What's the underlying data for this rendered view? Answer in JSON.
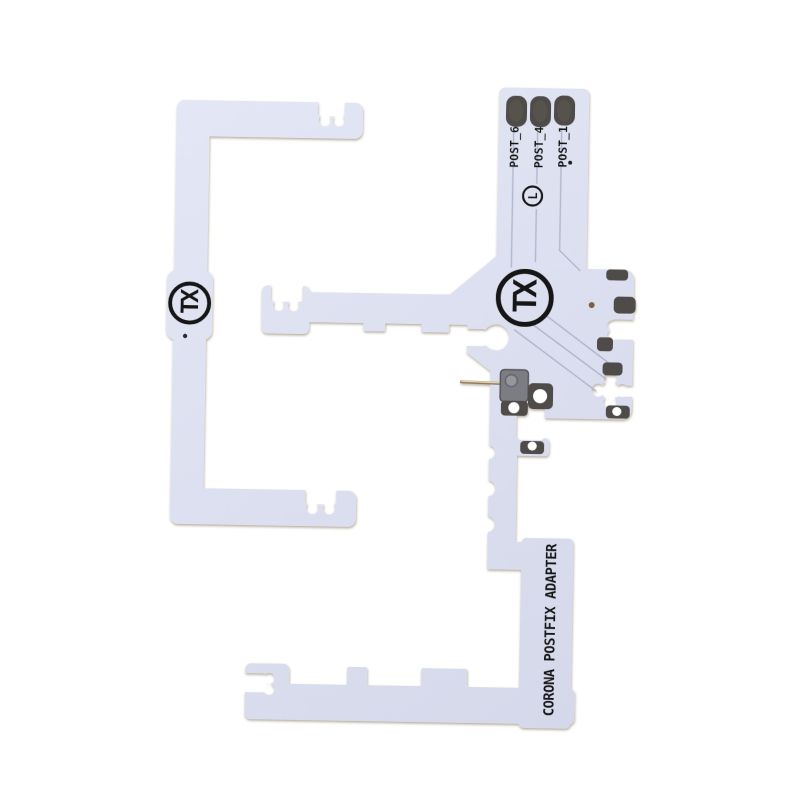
{
  "photo": {
    "background_color": "#ffffff",
    "board_color": "#dcdfef",
    "pad_color": "#4f4c48",
    "silkscreen_color": "#131313",
    "main_board": {
      "logo_text": "TX",
      "certification_mark": "L",
      "post_labels": [
        "POST_6",
        "POST_4",
        "POST_1"
      ],
      "title_text": "CORONA POSTFIX ADAPTER"
    },
    "left_board": {
      "logo_text": "TX"
    }
  }
}
